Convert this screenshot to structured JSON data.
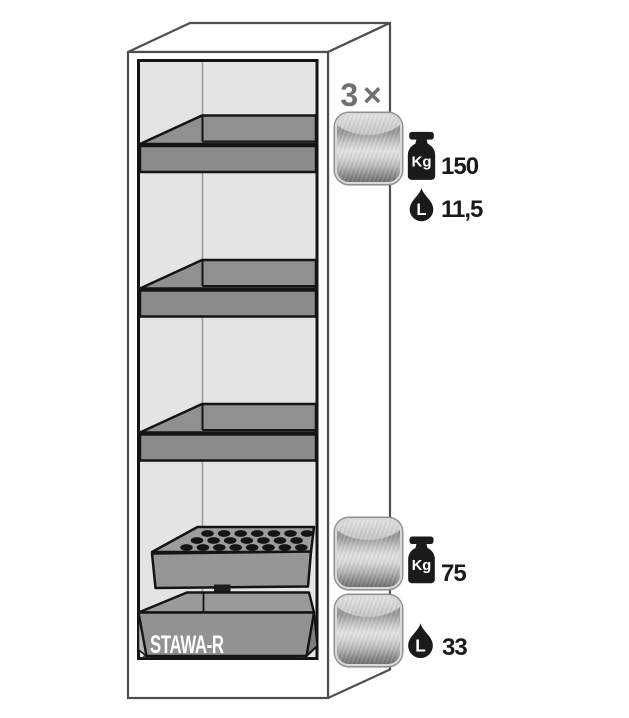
{
  "illustration": {
    "sump_label": "STAWA-R"
  },
  "specs": {
    "shelf": {
      "multiplier": "3 ×",
      "load_unit": "Kg",
      "load_value": "150",
      "volume_unit": "L",
      "volume_value": "11,5"
    },
    "insert": {
      "load_unit": "Kg",
      "load_value": "75"
    },
    "sump": {
      "volume_unit": "L",
      "volume_value": "33"
    }
  },
  "colors": {
    "outline": "#4f4f4f",
    "interior_wall": "#e4e4e4",
    "steel_part": "#8e8e8e",
    "ink": "#1a1a1a",
    "muted_label": "#6f6f6f",
    "sump_label_text": "#ffffff"
  }
}
